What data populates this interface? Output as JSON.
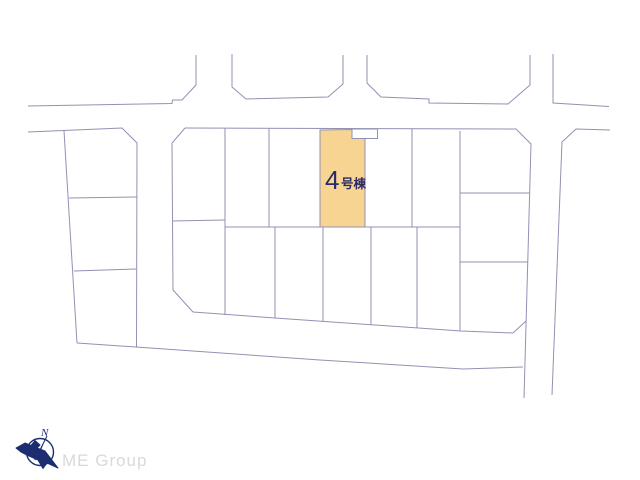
{
  "plan": {
    "highlight_label": {
      "number": "4",
      "suffix": "号棟"
    },
    "colors": {
      "lot_fill": "#f8d492",
      "line": "#9191b3",
      "label_text": "#2a2a66",
      "logo_navy": "#1c2d72",
      "logo_gray": "#d9d9d9",
      "background": "#ffffff"
    }
  },
  "logo": {
    "company": "ME Group",
    "compass_letter": "N"
  }
}
